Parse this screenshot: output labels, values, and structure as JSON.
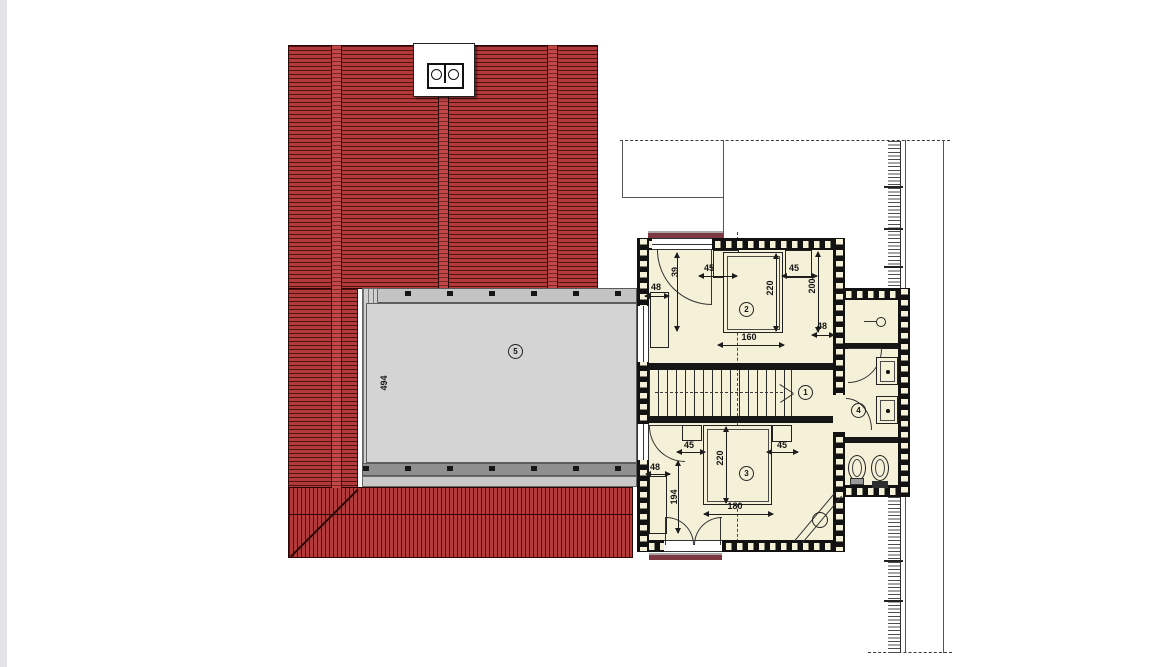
{
  "colors": {
    "roof_red": "#b23a3b",
    "roof_line": "#2c0606",
    "terrace_gray": "#d4d4d4",
    "floor_cream": "#f5f0d8",
    "wall_black": "#121212",
    "canopy_maroon": "#7e3844"
  },
  "labels": {
    "stair_hall": "1",
    "bedroom_top": "2",
    "bedroom_bottom": "3",
    "bathroom": "4",
    "terrace": "5"
  },
  "dimensions": {
    "terrace_depth": "494",
    "room2_closet_width": "48",
    "room2_door": "39",
    "room2_nightstand_left": "45",
    "room2_bed_length": "220",
    "room2_nightstand_right": "45",
    "room2_wall_depth": "200",
    "room2_right_width": "48",
    "room2_bed_width": "160",
    "room3_nightstand_left": "45",
    "room3_bed_length": "220",
    "room3_nightstand_right": "45",
    "room3_closet_width": "48",
    "room3_left_depth": "194",
    "room3_bed_width": "180"
  }
}
